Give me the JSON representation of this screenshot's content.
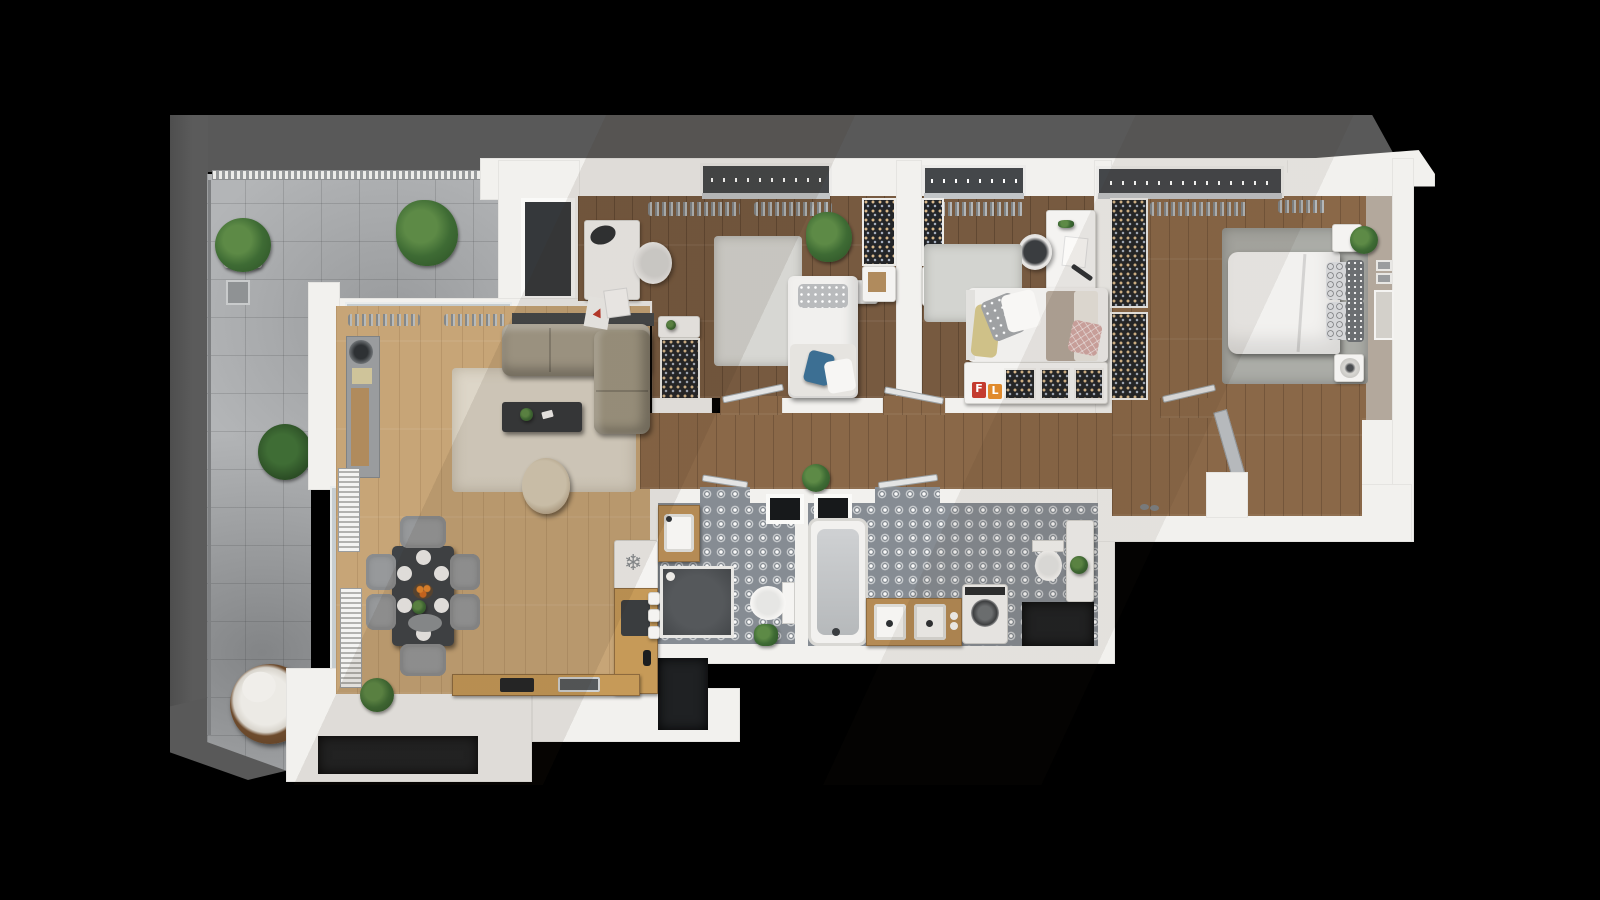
{
  "scene": {
    "label": "Top-down 3D rendered floor plan of a three-bedroom apartment with a wrap-around tiled terrace, on a black background",
    "canvas": {
      "width": 1600,
      "height": 900
    },
    "background": "#000000"
  },
  "palette": {
    "roof_gray": "#595959",
    "terrace_tile": "#b3b5b7",
    "wall_white": "#f2f1ee",
    "accent_wall_taupe": "#b3a89c",
    "wood_light": "#c7a577",
    "wood_medium": "#8a6848",
    "wood_dark": "#775a40",
    "bath_tile_gray": "#868c93",
    "wardrobe_dark": "#232528",
    "sofa_beige": "#a59d8b",
    "rug_cream": "#ddd6c8",
    "rug_gray": "#d3d4d0",
    "pillow_blue": "#3c6f93",
    "pillow_yellow": "#cfc188",
    "pillow_pink": "#d3a8a4",
    "counter_wood": "#c69a58"
  },
  "icons": {
    "snowflake": "❄"
  },
  "labels": {
    "toy_letter_1": "F",
    "toy_letter_2": "L"
  },
  "rooms": [
    {
      "id": "terrace",
      "name": "terrace",
      "floor": "concrete tiles",
      "items": [
        "potted plants",
        "lantern",
        "hanging egg chair",
        "radiator shutters"
      ]
    },
    {
      "id": "living-room",
      "name": "living and dining room",
      "floor": "light oak planks",
      "items": [
        "corner sofa",
        "cream rug",
        "coffee table",
        "round armchair",
        "console",
        "dining table for six"
      ]
    },
    {
      "id": "kitchen",
      "name": "kitchen",
      "floor": "light oak planks",
      "items": [
        "fridge with snowflake icon",
        "L-shaped wooden counter",
        "cooktop",
        "sink"
      ]
    },
    {
      "id": "bedroom-1",
      "name": "bedroom 1 with desk nook",
      "floor": "dark oak planks",
      "items": [
        "desk",
        "chair",
        "single bed with blue cushion",
        "rug",
        "plant",
        "two open wardrobes"
      ]
    },
    {
      "id": "bedroom-2",
      "name": "bedroom 2 (kids room)",
      "floor": "dark oak planks",
      "items": [
        "desk",
        "chair",
        "bed with yellow and pink pillows",
        "rug",
        "low wardrobe shelf with toys"
      ]
    },
    {
      "id": "master-bedroom",
      "name": "master bedroom",
      "floor": "medium oak planks",
      "items": [
        "double bed",
        "gray rug",
        "two nightstands",
        "plant",
        "two open wardrobes",
        "taupe accent wall with mirror"
      ]
    },
    {
      "id": "shower-room",
      "name": "shower room",
      "floor": "patterned gray tile",
      "items": [
        "wood vanity with sink",
        "walk-in shower",
        "toilet",
        "plant"
      ]
    },
    {
      "id": "bathroom",
      "name": "main bathroom",
      "floor": "patterned gray tile",
      "items": [
        "bathtub",
        "double wood vanity",
        "washing machine",
        "toilet",
        "tall cabinet",
        "dark storage niche"
      ]
    },
    {
      "id": "hallway",
      "name": "hallway and entry",
      "floor": "medium oak planks",
      "items": [
        "plant",
        "open interior doors",
        "gray entrance door",
        "shoes"
      ]
    }
  ]
}
